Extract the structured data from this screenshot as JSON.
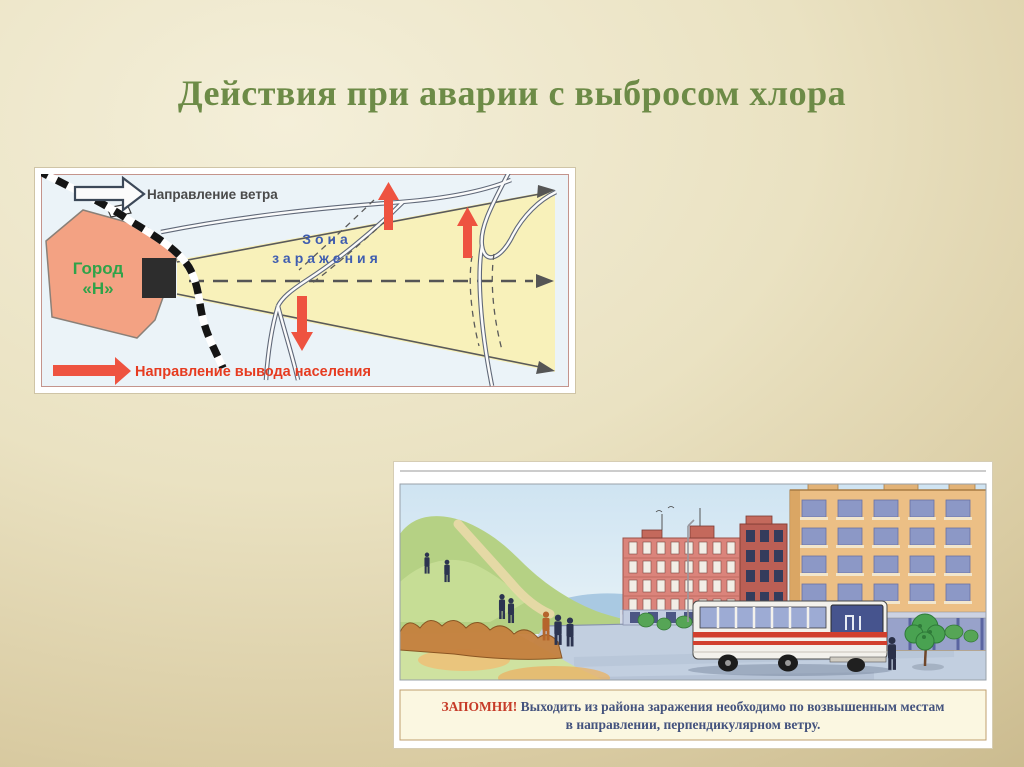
{
  "slide": {
    "title": "Действия при аварии с выбросом хлора"
  },
  "map": {
    "wind_label": "Направление ветра",
    "city_line1": "Город",
    "city_line2": "«Н»",
    "zone_line1": "Зона",
    "zone_line2": "заражения",
    "evacuation_label": "Направление вывода населения"
  },
  "illustration": {
    "caption_prefix": "ЗАПОМНИ!",
    "caption_line1": " Выходить из района заражения необходимо по возвышенным местам",
    "caption_line2": "в направлении, перпендикулярном ветру."
  },
  "colors": {
    "background_center": "#f3eed8",
    "background_edge": "#c0af81",
    "title_green": "#6d8b47",
    "alert_red": "#ee5340",
    "zone_yellow": "#f8f1ba",
    "city_salmon": "#f3a283",
    "zone_label_blue": "#3f5db0",
    "city_label_green": "#2fa349",
    "caption_red": "#c63b28",
    "caption_blue": "#44537e"
  }
}
